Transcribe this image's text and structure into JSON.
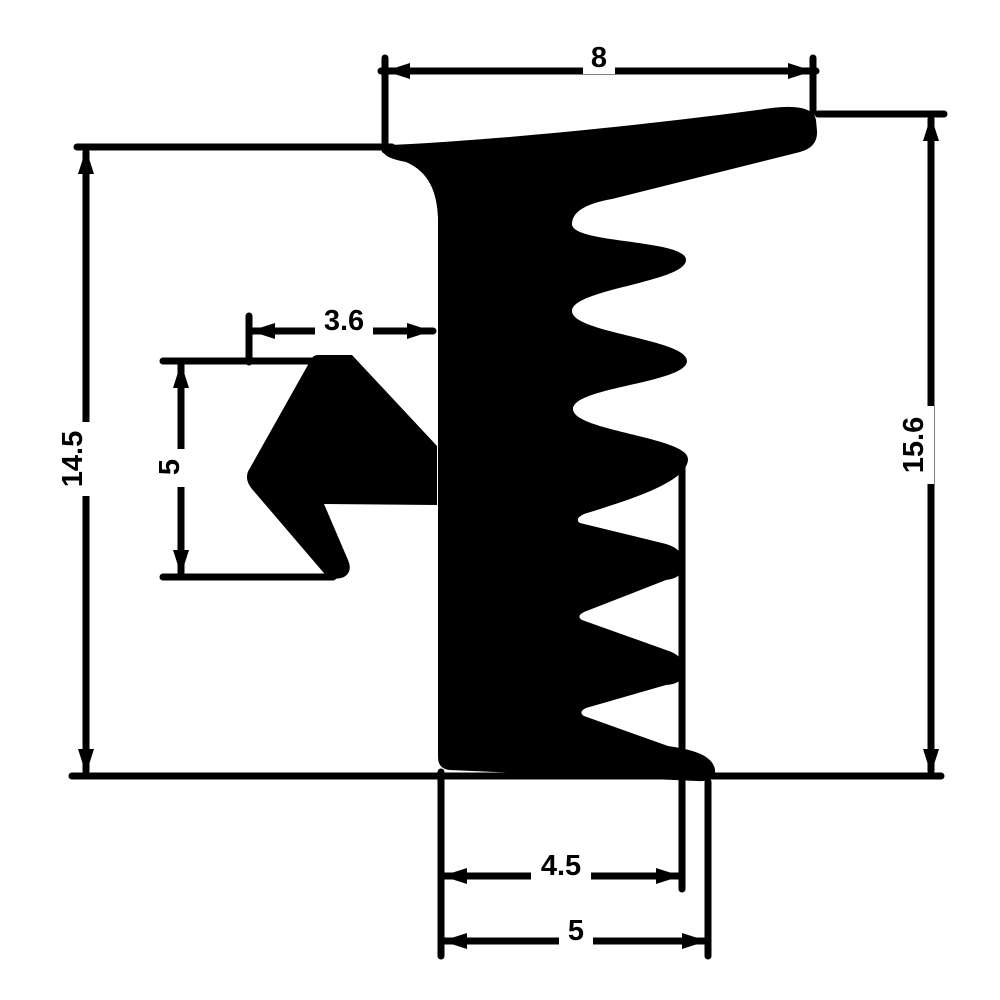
{
  "drawing": {
    "background": "#ffffff",
    "ink": "#000000",
    "type_label": "seal-profile-cross-section",
    "dimensions": {
      "top_width": {
        "value": "8"
      },
      "left_height": {
        "value": "14.5"
      },
      "right_height": {
        "value": "15.6"
      },
      "barb_width": {
        "value": "3.6"
      },
      "barb_height": {
        "value": "5"
      },
      "foot_width_inner": {
        "value": "4.5"
      },
      "foot_width_outer": {
        "value": "5"
      }
    }
  }
}
